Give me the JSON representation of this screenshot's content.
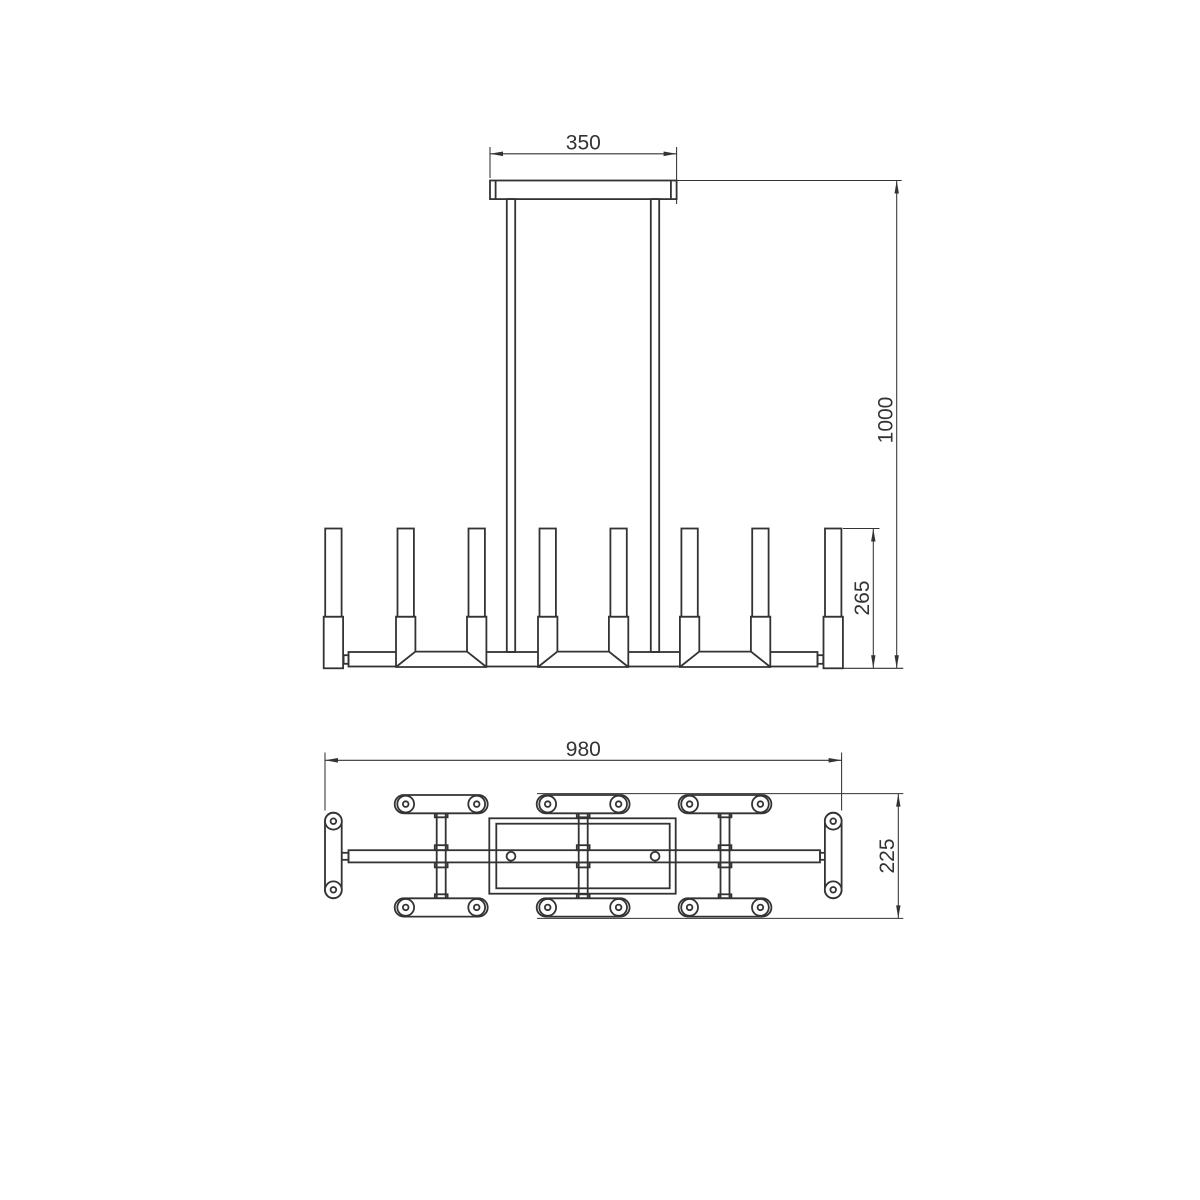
{
  "drawing": {
    "type": "technical-dimension-drawing",
    "subject": "linear chandelier with candle lamps, front elevation and top plan view",
    "background": "#ffffff",
    "line_color": "#333333",
    "dims": {
      "canopy_width": "350",
      "suspension_height": "1000",
      "candle_height": "265",
      "fixture_length": "980",
      "fixture_depth": "225"
    }
  }
}
